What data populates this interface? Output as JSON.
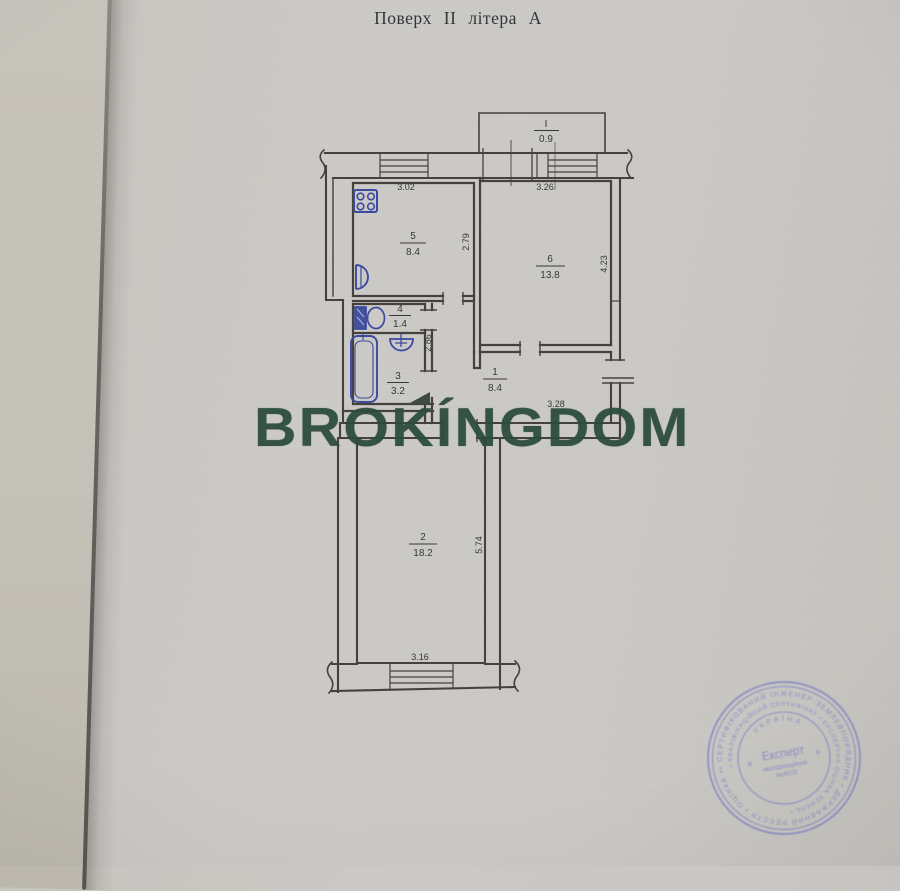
{
  "document": {
    "title": "Поверх II літера А",
    "watermark": "BROKÍNGDOM"
  },
  "plan": {
    "rooms": [
      {
        "number": "I",
        "area": "0.9"
      },
      {
        "number": "5",
        "area": "8.4"
      },
      {
        "number": "6",
        "area": "13.8"
      },
      {
        "number": "4",
        "area": "1.4"
      },
      {
        "number": "3",
        "area": "3.2"
      },
      {
        "number": "1",
        "area": "8.4"
      },
      {
        "number": "2",
        "area": "18.2"
      }
    ],
    "dimensions": {
      "kitchen_width": "3.02",
      "room6_width": "3.26",
      "kitchen_depth": "2.79",
      "room6_depth": "4.23",
      "hall_depth": "2.86",
      "hall_width": "3.28",
      "room2_depth": "5.74",
      "room2_width": "3.16"
    }
  },
  "stamp": {
    "center_title": "Експерт",
    "center_line2": "кваліфікаційний",
    "center_line3": "№4615",
    "inner_arc": "УКРАЇНА",
    "ring_outer": "• СЕРТИФІКОВАНИЙ ІНЖЕНЕР-ЗЕМЛЕВПОРЯДНИК • ДЕРЖАВНИЙ РЕЄСТР • ОЦІНКА •",
    "ring_inner": "• КВАЛІФІКАЦІЙНИЙ СЕРТИФІКАТ • ЕКСПЕРТНА ОЦІНКА ЗЕМЕЛЬ •",
    "color": "#7d81c6"
  },
  "colors": {
    "paper": "#cac8c4",
    "plan_lines": "#45423e",
    "fixtures": "#3c4aa0",
    "watermark_green": "#2b4c3d",
    "stamp_purple": "#7d81c6"
  }
}
